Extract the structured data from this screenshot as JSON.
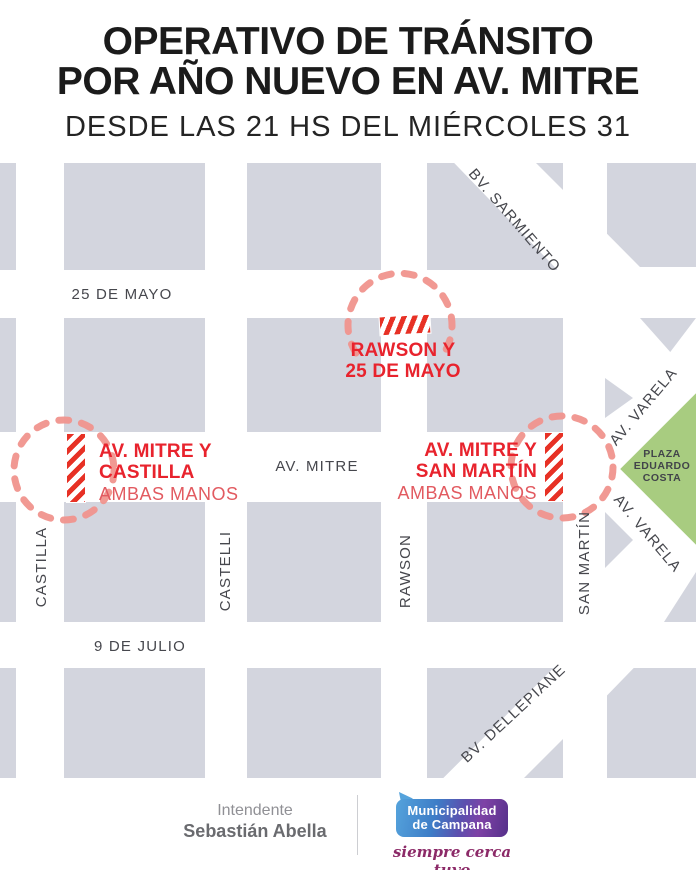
{
  "header": {
    "title_line1": "OPERATIVO DE TRÁNSITO",
    "title_line2": "POR AÑO NUEVO EN AV. MITRE",
    "subtitle": "DESDE LAS 21 HS DEL MIÉRCOLES 31"
  },
  "map": {
    "streets": {
      "h_25_de_mayo": "25 DE MAYO",
      "h_av_mitre": "AV. MITRE",
      "h_9_de_julio": "9 DE JULIO",
      "v_castilla": "CASTILLA",
      "v_castelli": "CASTELLI",
      "v_rawson": "RAWSON",
      "v_san_martin": "SAN MARTÍN",
      "d_sarmiento": "BV. SARMIENTO",
      "d_varela_upper": "AV. VARELA",
      "d_varela_lower": "AV. VARELA",
      "d_dellepiane": "BV. DELLEPIANE"
    },
    "closures": {
      "rawson": {
        "line1": "RAWSON Y",
        "line2": "25 DE MAYO"
      },
      "castilla": {
        "line1": "AV. MITRE Y",
        "line2": "CASTILLA",
        "note": "AMBAS MANOS"
      },
      "san_martin": {
        "line1": "AV. MITRE Y",
        "line2": "SAN MARTÍN",
        "note": "AMBAS MANOS"
      }
    },
    "plaza": {
      "line1": "PLAZA",
      "line2": "EDUARDO",
      "line3": "COSTA"
    }
  },
  "footer": {
    "official_title": "Intendente",
    "official_name": "Sebastián Abella",
    "logo_line1": "Municipalidad",
    "logo_line2": "de Campana",
    "slogan": "siempre cerca tuyo"
  },
  "colors": {
    "accent_red": "#e8232d",
    "note_red": "#e25a60",
    "dash_salmon": "#f0938d",
    "block_gray": "#d3d5de",
    "plaza_green": "#a8cc80",
    "logo_blue": "#4b94d6",
    "logo_purple": "#6a3d9e",
    "slogan_purple": "#8c2a68"
  }
}
